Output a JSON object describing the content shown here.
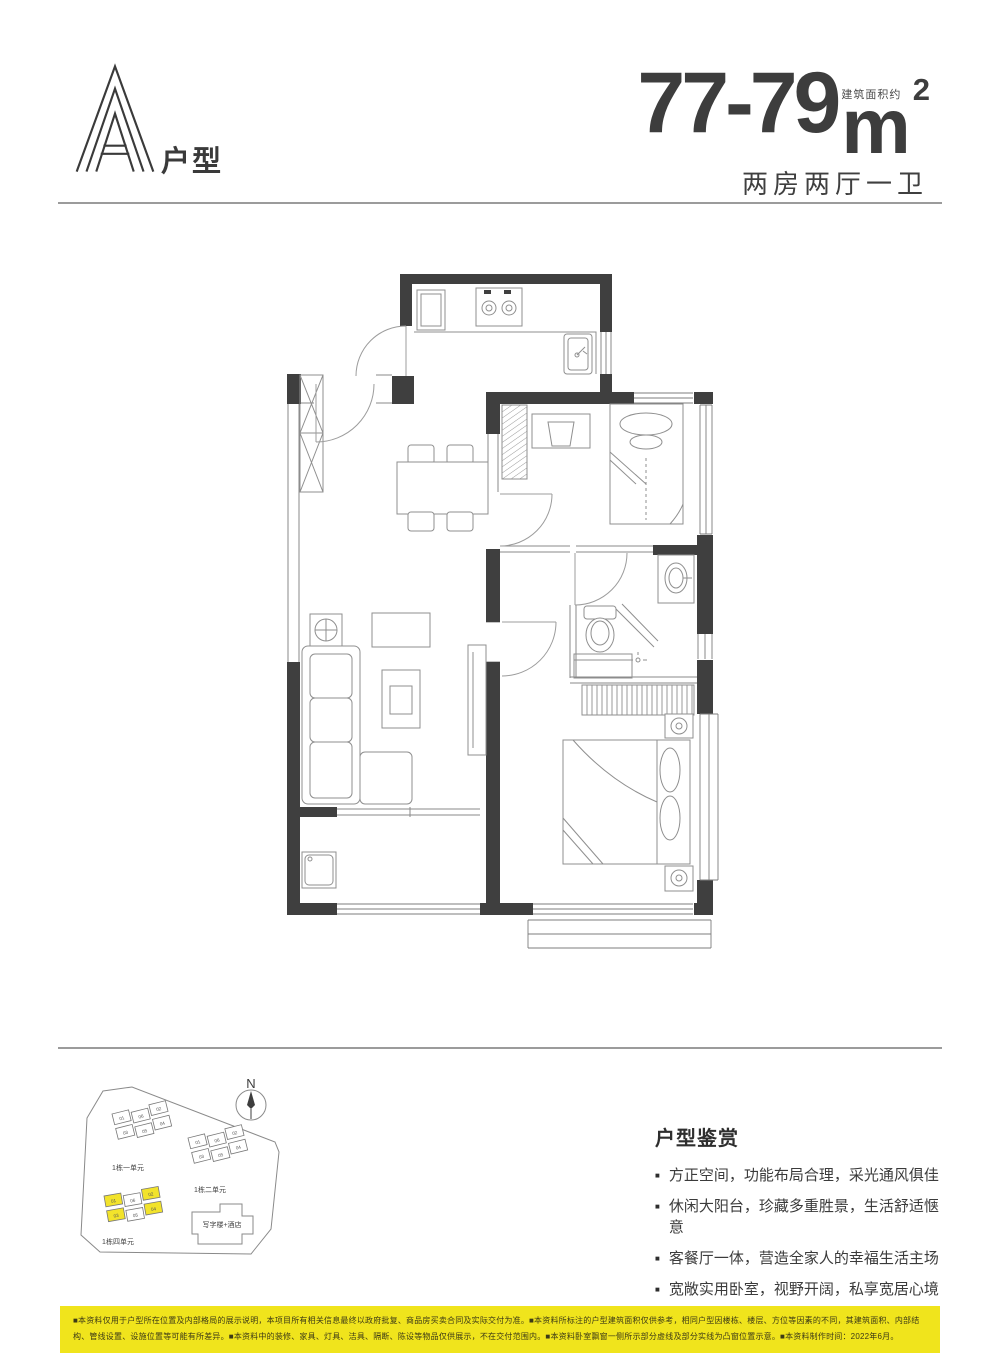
{
  "header": {
    "unit_letter": "A",
    "unit_label": "户型",
    "area_range": "77-79",
    "area_unit": "m",
    "area_sup": "2",
    "area_note": "建筑面积约",
    "layout_desc": "两房两厅一卫"
  },
  "siteplan": {
    "north_label": "N",
    "clusters": [
      {
        "label": "1栋一单元",
        "units": [
          "01",
          "06",
          "02",
          "03",
          "05",
          "04"
        ],
        "highlighted": []
      },
      {
        "label": "1栋二单元",
        "units": [
          "01",
          "06",
          "02",
          "03",
          "05",
          "04"
        ],
        "highlighted": []
      },
      {
        "label": "1栋四单元",
        "units": [
          "01",
          "06",
          "02",
          "03",
          "05",
          "04"
        ],
        "highlighted": [
          "01",
          "02",
          "03",
          "04"
        ]
      }
    ],
    "building_label": "写字楼+酒店",
    "highlight_color": "#f2e32b"
  },
  "review": {
    "title": "户型鉴赏",
    "bullets": [
      "方正空间，功能布局合理，采光通风俱佳",
      "休闲大阳台，珍藏多重胜景，生活舒适惬意",
      "客餐厅一体，营造全家人的幸福生活主场",
      "宽敞实用卧室，视野开阔，私享宽居心境"
    ]
  },
  "disclaimer": {
    "text": "■本资料仅用于户型所在位置及内部格局的展示说明，本项目所有相关信息最终以政府批复、商品房买卖合同及实际交付为准。■本资料所标注的户型建筑面积仅供参考，相同户型因楼栋、楼层、方位等因素的不同，其建筑面积、内部结构、管线设置、设施位置等可能有所差异。■本资料中的装修、家具、灯具、洁具、隔断、陈设等物品仅供展示，不在交付范围内。■本资料卧室飘窗一侧所示部分虚线及部分实线为凸窗位置示意。■本资料制作时间：2022年6月。",
    "bg_color": "#f0e41c"
  }
}
